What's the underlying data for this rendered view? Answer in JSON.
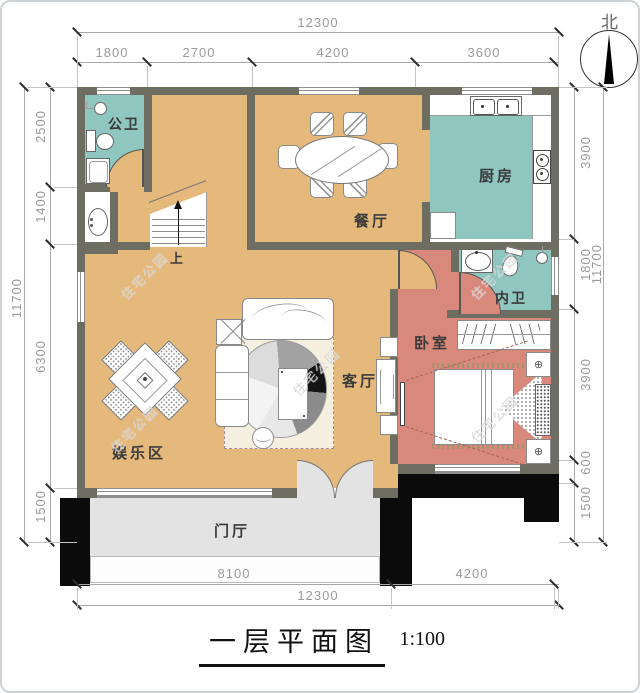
{
  "title": {
    "text": "一层平面图",
    "scale": "1:100"
  },
  "north": {
    "label": "北"
  },
  "watermark": {
    "text": "住宅公园"
  },
  "stairs": {
    "up_label": "上"
  },
  "rooms": {
    "gongwei": {
      "label": "公卫"
    },
    "chufang": {
      "label": "厨房"
    },
    "canting": {
      "label": "餐厅"
    },
    "neiwei": {
      "label": "内卫"
    },
    "woshi": {
      "label": "卧室"
    },
    "keting": {
      "label": "客厅"
    },
    "yulequ": {
      "label": "娱乐区"
    },
    "menting": {
      "label": "门厅"
    }
  },
  "dims": {
    "top": {
      "total": "12300",
      "segments": [
        "1800",
        "2700",
        "4200",
        "3600"
      ]
    },
    "bottom": {
      "total": "12300",
      "segments": [
        "8100",
        "4200"
      ]
    },
    "left": {
      "total": "11700",
      "segments": [
        "2500",
        "1400",
        "6300",
        "1500"
      ]
    },
    "right": {
      "total": "11700",
      "segments": [
        "3900",
        "1800",
        "3900",
        "600",
        "1500"
      ]
    }
  },
  "icons": {
    "lamp": "⊕"
  },
  "colors": {
    "floor_tan": "#e5b87c",
    "wet_teal": "#8fc6c0",
    "bedroom_salmon": "#d8897b",
    "wall_gray": "#6e6d61",
    "porch_black": "#0b0b0b",
    "hall_gray": "#e3e3e3",
    "rug_cream": "#f5efe0"
  }
}
